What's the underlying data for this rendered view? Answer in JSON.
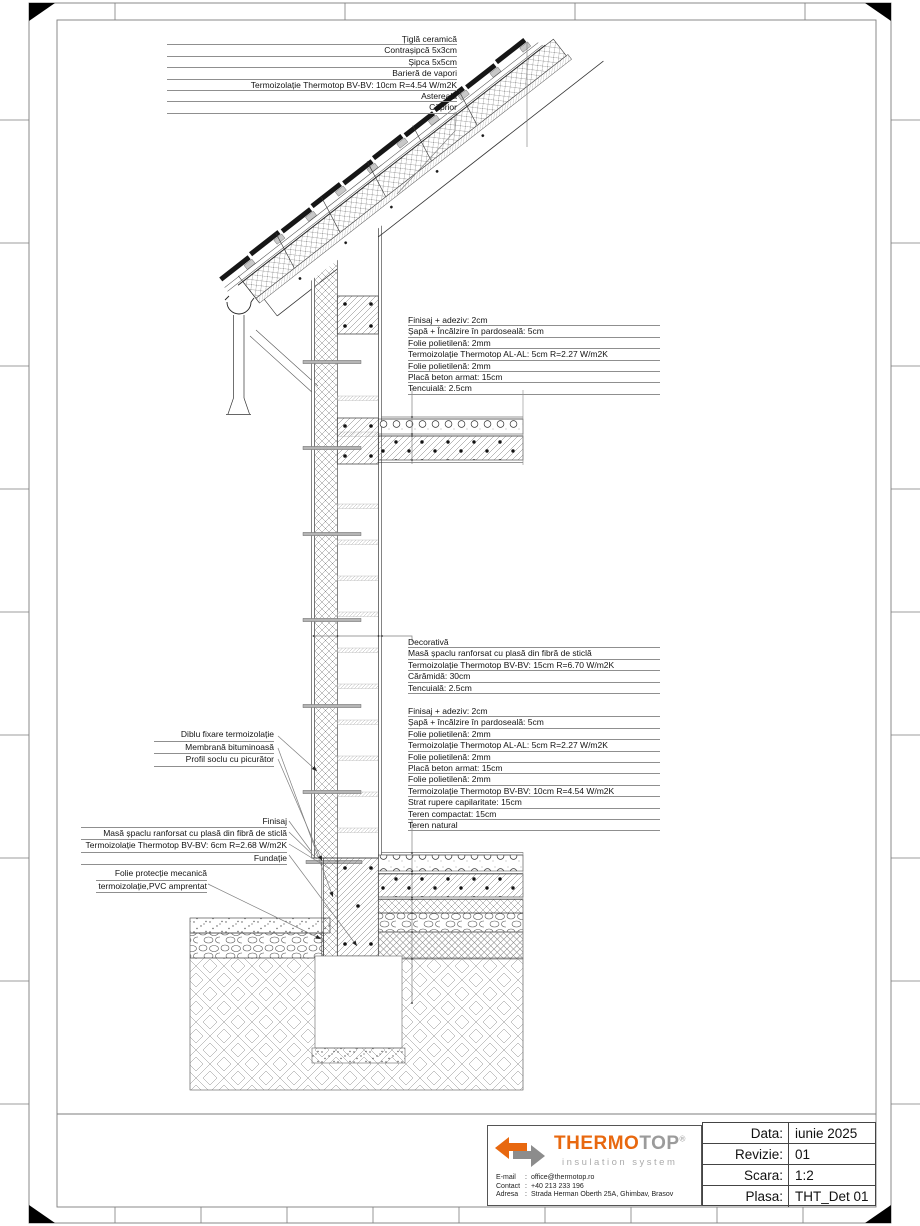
{
  "annotations": {
    "roof_layers": {
      "lines": [
        "Țiglă ceramică",
        "Contrașipcă 5x3cm",
        "Șipca 5x5cm",
        "Barieră de vapori",
        "Termoizolație Thermotop BV-BV: 10cm R=4.54 W/m2K",
        "Astereală",
        "Căprior"
      ]
    },
    "floor_upper_layers": {
      "lines": [
        "Finisaj + adeziv: 2cm",
        "Șapă + Încălzire în pardoseală: 5cm",
        "Folie polietilenă: 2mm",
        "Termoizolație Thermotop AL-AL: 5cm R=2.27 W/m2K",
        "Folie polietilenă: 2mm",
        "Placă beton armat: 15cm",
        "Tencuială: 2.5cm"
      ]
    },
    "wall_layers": {
      "lines": [
        "Decorativă",
        "Masă șpaclu ranforsat cu plasă din fibră de sticlă",
        "Termoizolație Thermotop BV-BV: 15cm R=6.70 W/m2K",
        "Cărămidă: 30cm",
        "Tencuială: 2.5cm"
      ]
    },
    "floor_ground_layers": {
      "lines": [
        "Finisaj + adeziv: 2cm",
        "Șapă + încălzire în pardoseală: 5cm",
        "Folie polietilenă: 2mm",
        "Termoizolație Thermotop AL-AL: 5cm R=2.27 W/m2K",
        "Folie polietilenă: 2mm",
        "Placă beton armat: 15cm",
        "Folie polietilenă: 2mm",
        "Termoizolație Thermotop BV-BV: 10cm R=4.54 W/m2K",
        "Strat rupere capilaritate: 15cm",
        "Teren compactat: 15cm",
        "Teren natural"
      ]
    },
    "fixing_labels": {
      "lines": [
        "Diblu fixare termoizolație",
        "Membrană bituminoasă",
        "Profil soclu cu picurător"
      ]
    },
    "plinth_labels": {
      "lines": [
        "Finisaj",
        "Masă șpaclu ranforsat cu plasă din fibră de sticlă",
        "Termoizolație Thermotop BV-BV: 6cm R=2.68 W/m2K",
        "Fundație"
      ]
    },
    "protection_label": {
      "lines": [
        "Folie protecție mecanică",
        "termoizolație,PVC amprentat"
      ]
    }
  },
  "title_block": {
    "sep": ":",
    "brand": {
      "name_primary": "THERMO",
      "name_secondary": "TOP",
      "registered": "®",
      "tagline": "insulation system"
    },
    "contact": [
      {
        "label": "E-mail",
        "value": "office@thermotop.ro"
      },
      {
        "label": "Contact",
        "value": "+40 213 233 196"
      },
      {
        "label": "Adresa",
        "value": "Strada Herman Oberth 25A, Ghimbav, Brasov"
      }
    ],
    "info_table": {
      "rows": [
        {
          "label": "Data:",
          "value": "iunie 2025"
        },
        {
          "label": "Revizie:",
          "value": "01"
        },
        {
          "label": "Scara:",
          "value": "1:2"
        },
        {
          "label": "Plasa:",
          "value": "THT_Det 01"
        }
      ]
    }
  },
  "colors": {
    "brand_orange": "#E8680F",
    "brand_gray": "#9B9B9B",
    "line_dark": "#2B2B2B",
    "leader_gray": "#8F8F8F"
  }
}
